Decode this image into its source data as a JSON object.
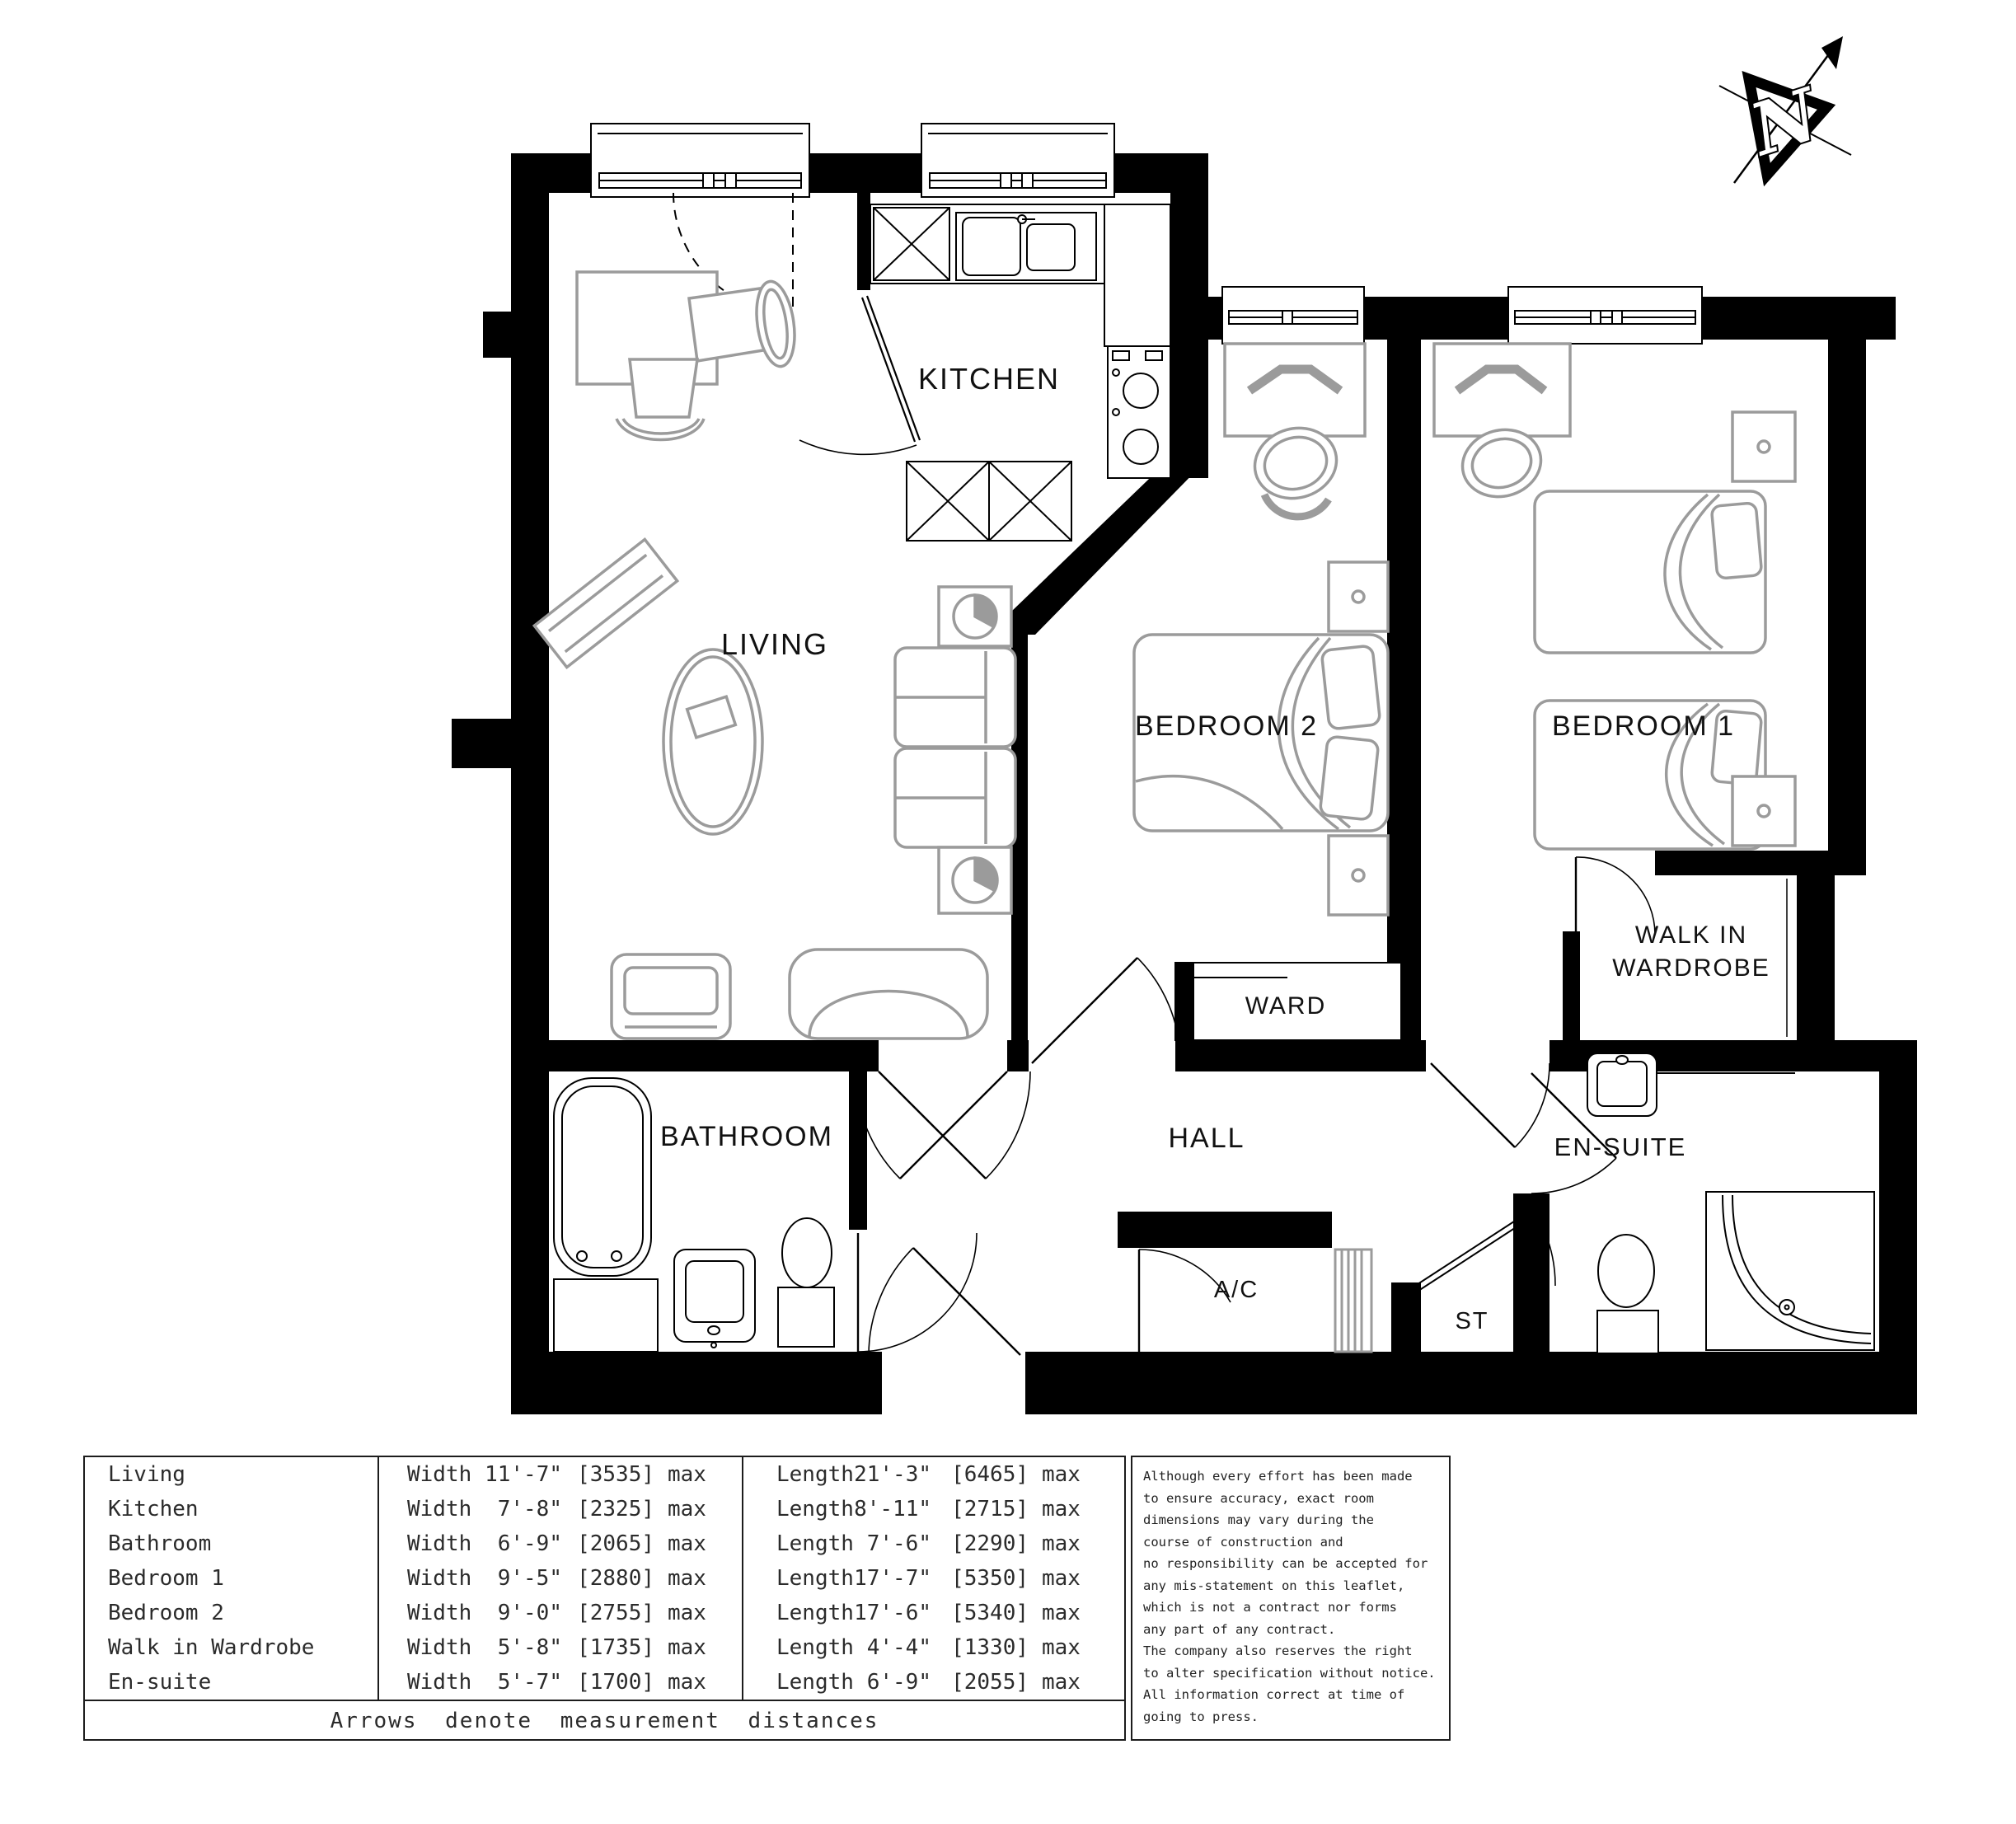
{
  "plan": {
    "rooms": {
      "living": "LIVING",
      "kitchen": "KITCHEN",
      "bedroom2": "BEDROOM 2",
      "bedroom1": "BEDROOM 1",
      "walk_in_line1": "WALK IN",
      "walk_in_line2": "WARDROBE",
      "ward": "WARD",
      "hall": "HALL",
      "bathroom": "BATHROOM",
      "ac": "A/C",
      "st": "ST",
      "ensuite": "EN-SUITE"
    },
    "north_label": "N"
  },
  "table": {
    "labels": {
      "width": "Width",
      "length": "Length",
      "max": "max"
    },
    "rows": [
      {
        "name": "Living",
        "width": "11'-7\"",
        "width_mm": "[3535]",
        "length": "21'-3\"",
        "length_mm": "[6465]"
      },
      {
        "name": "Kitchen",
        "width": "7'-8\"",
        "width_mm": "[2325]",
        "length": "8'-11\"",
        "length_mm": "[2715]"
      },
      {
        "name": "Bathroom",
        "width": "6'-9\"",
        "width_mm": "[2065]",
        "length": "7'-6\"",
        "length_mm": "[2290]"
      },
      {
        "name": "Bedroom 1",
        "width": "9'-5\"",
        "width_mm": "[2880]",
        "length": "17'-7\"",
        "length_mm": "[5350]"
      },
      {
        "name": "Bedroom 2",
        "width": "9'-0\"",
        "width_mm": "[2755]",
        "length": "17'-6\"",
        "length_mm": "[5340]"
      },
      {
        "name": "Walk in Wardrobe",
        "width": "5'-8\"",
        "width_mm": "[1735]",
        "length": "4'-4\"",
        "length_mm": "[1330]"
      },
      {
        "name": "En-suite",
        "width": "5'-7\"",
        "width_mm": "[1700]",
        "length": "6'-9\"",
        "length_mm": "[2055]"
      }
    ],
    "footer": "Arrows denote measurement distances"
  },
  "disclaimer": "Although every effort has been made\nto ensure accuracy, exact room\ndimensions may vary during the\ncourse of construction and\nno responsibility can be accepted for\nany mis-statement on this leaflet,\nwhich is not a contract nor forms\nany part of any contract.\nThe company also reserves the right\nto alter specification without notice.\nAll information correct at time of\ngoing to press."
}
